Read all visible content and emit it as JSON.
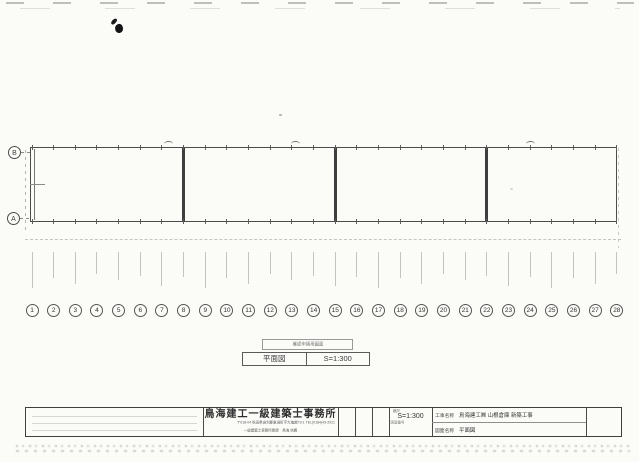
{
  "meta": {
    "doc_type": "scanned architectural drawing sheet"
  },
  "drawing": {
    "row_bubbles": [
      "B",
      "A"
    ],
    "columns": [
      "1",
      "2",
      "3",
      "4",
      "5",
      "6",
      "7",
      "8",
      "9",
      "10",
      "11",
      "12",
      "13",
      "14",
      "15",
      "16",
      "17",
      "18",
      "19",
      "20",
      "21",
      "22",
      "23",
      "24",
      "25",
      "26",
      "27",
      "28"
    ],
    "caption_note": "確認申請用図面",
    "caption_title": "平面図",
    "caption_scale": "S=1:300"
  },
  "title_block": {
    "firm_name": "鳥海建工一級建築士事務所",
    "firm_address": "〒018-04 秋田県由利郡象潟町字大塩越73-1 TEL(0184)43-2021",
    "firm_license": "一級建築士事務所登録　鳥海 信義",
    "scale_label": "縮尺",
    "scale_value": "S=1:300",
    "scale_sub": "図面番号",
    "project_label": "工事名称",
    "project_value": "鳥海建工㈱ 山根倉庫 新築工事",
    "drawing_label": "図面名称",
    "drawing_value": "平面図"
  },
  "colors": {
    "paper": "#fbfbf8",
    "line": "#4c4c4c",
    "faint": "#c3c3c3"
  }
}
